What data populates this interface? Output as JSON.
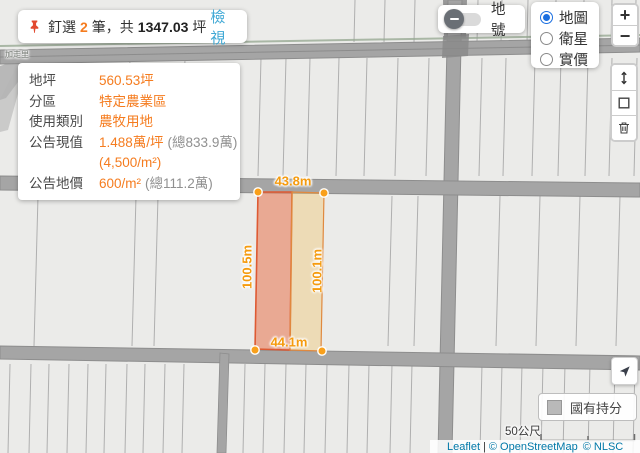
{
  "colors": {
    "accent_orange": "#F57C1F",
    "link_blue": "#3FA8D5",
    "radio_blue": "#1B6FE0",
    "parcel_left_fill": "#EFA183",
    "parcel_right_fill": "#F3E3BE",
    "legend_swatch": "#B9B9B9"
  },
  "pinned_bar": {
    "pin_icon": "pushpin-icon",
    "prefix": "釘選",
    "count": "2",
    "middle": "筆，共",
    "total": "1347.03",
    "unit": "坪",
    "view_label": "檢視"
  },
  "info_panel": {
    "rows": [
      {
        "label": "地坪",
        "value": "560.53坪",
        "note": ""
      },
      {
        "label": "分區",
        "value": "特定農業區",
        "note": ""
      },
      {
        "label": "使用類別",
        "value": "農牧用地",
        "note": ""
      },
      {
        "label": "公告現值",
        "value": "1.488萬/坪",
        "note": "(總833.9萬)"
      },
      {
        "label": "",
        "value": "(4,500/m²)",
        "note": ""
      },
      {
        "label": "公告地價",
        "value": "600/m²",
        "note": "(總111.2萬)"
      }
    ]
  },
  "layer_toggle": {
    "label": "地號",
    "state": "off"
  },
  "base_layers": {
    "options": [
      {
        "label": "地圖",
        "selected": true
      },
      {
        "label": "衛星",
        "selected": false
      },
      {
        "label": "實價",
        "selected": false
      }
    ]
  },
  "zoom_control": {
    "zoom_in": "+",
    "zoom_out": "−"
  },
  "measure_toolbar": {
    "tools": [
      "measure-distance-icon",
      "measure-area-icon",
      "trash-icon"
    ]
  },
  "locate_control": {
    "icon": "navigation-arrow-icon"
  },
  "legend": {
    "swatch": "gray-square-swatch",
    "label": "國有持分"
  },
  "scale_control": {
    "label": "50公尺"
  },
  "attribution": {
    "flag_icon": "ukraine-flag-icon",
    "leaflet": "Leaflet",
    "separator": "|",
    "osm": "© OpenStreetMap",
    "nlsc": "© NLSC"
  },
  "map": {
    "place_label": "加走里",
    "measurements": {
      "top": "43.8m",
      "bottom": "44.1m",
      "left": "100.5m",
      "right": "100.1m"
    }
  }
}
